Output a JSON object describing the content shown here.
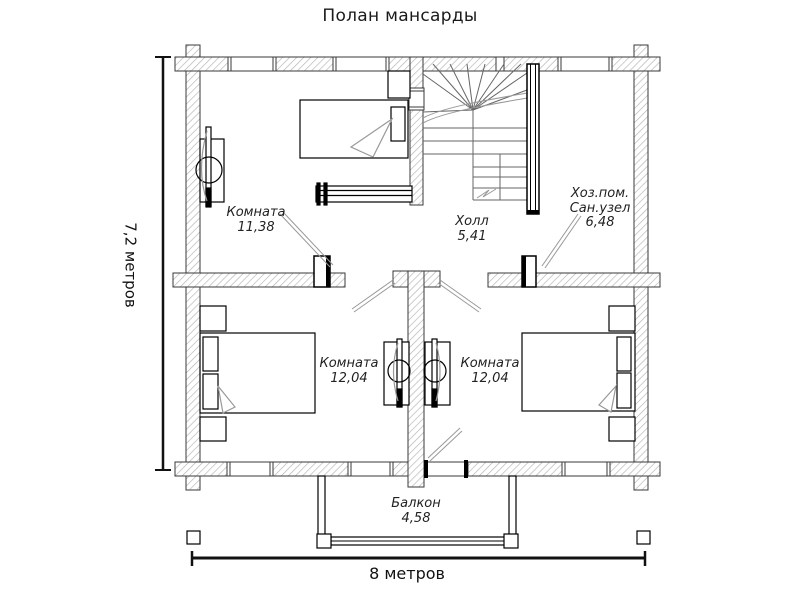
{
  "title": "Полан мансарды",
  "rooms": {
    "bedroom_top": {
      "name": "Комната",
      "area": "11,38"
    },
    "hall": {
      "name": "Холл",
      "area": "5,41"
    },
    "utility": {
      "name_line1": "Хоз.пом.",
      "name_line2": "Сан.узел",
      "area": "6,48"
    },
    "bedroom_left": {
      "name": "Комната",
      "area": "12,04"
    },
    "bedroom_right": {
      "name": "Комната",
      "area": "12,04"
    },
    "balcony": {
      "name": "Балкон",
      "area": "4,58"
    }
  },
  "dimensions": {
    "width_label": "8 метров",
    "height_label": "7,2 метров"
  },
  "colors": {
    "background": "#ffffff",
    "wall_outline": "#3a3a3a",
    "wall_hatch": "#b3b3b3",
    "drawing_line": "#000000",
    "soft_line": "#999999",
    "text": "#222222"
  }
}
